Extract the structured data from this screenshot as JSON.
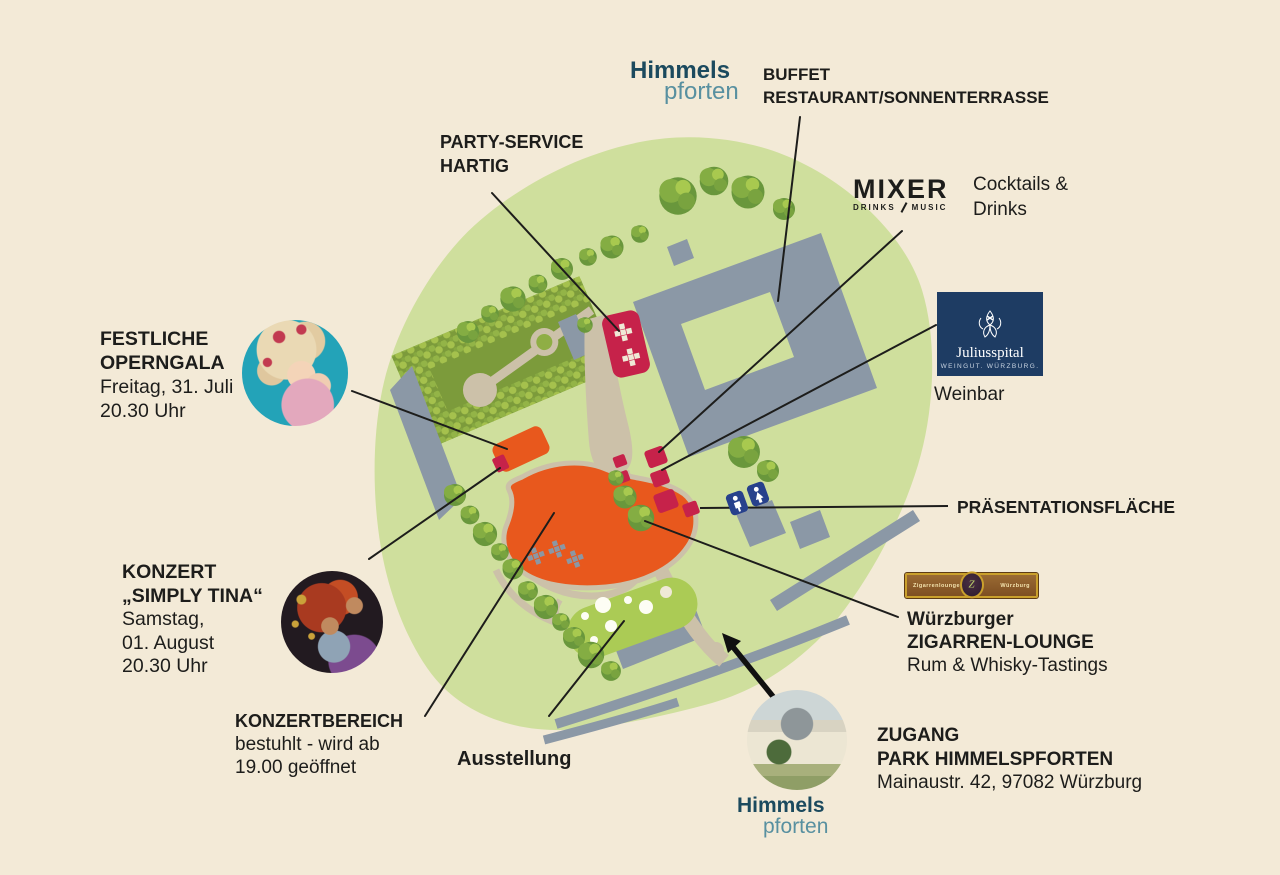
{
  "colors": {
    "background": "#f3ead7",
    "park_green": "#cfdf9d",
    "garden_green": "#7c9b3b",
    "exhibition_green": "#abcb55",
    "building_gray": "#8b98a6",
    "path_tan": "#ccc1a9",
    "stage_orange": "#e8581d",
    "booth_red": "#c6224a",
    "wc_blue": "#27418c",
    "line_black": "#1d1d1b",
    "logo_teal_dark": "#1b4a5e",
    "logo_teal_light": "#5890a0",
    "julius_navy": "#1e3c63",
    "zigarren_gold": "#caa02c"
  },
  "header_logo": {
    "word1": "Himmels",
    "word2": "pforten"
  },
  "footer_logo": {
    "word1": "Himmels",
    "word2": "pforten"
  },
  "annotations": {
    "buffet": {
      "line1": "BUFFET",
      "line2": "RESTAURANT/SONNENTERRASSE"
    },
    "party_service": {
      "line1": "PARTY-SERVICE",
      "line2": "HARTIG"
    },
    "mixer": {
      "logo_name": "MIXER",
      "logo_sub_left": "DRINKS",
      "logo_sub_right": "MUSIC",
      "desc_line1": "Cocktails &",
      "desc_line2": "Drinks"
    },
    "juliusspital": {
      "logo_name": "Juliusspital",
      "logo_sub": "WEINGUT. WÜRZBURG.",
      "desc": "Weinbar"
    },
    "operngala": {
      "title_line1": "FESTLICHE",
      "title_line2": "OPERNGALA",
      "detail_line1": "Freitag, 31. Juli",
      "detail_line2": "20.30 Uhr"
    },
    "simply_tina": {
      "title_line1": "KONZERT",
      "title_line2": "„SIMPLY TINA“",
      "detail_line1": "Samstag,",
      "detail_line2": "01. August",
      "detail_line3": "20.30 Uhr"
    },
    "konzertbereich": {
      "title": "KONZERTBEREICH",
      "detail_line1": "bestuhlt - wird ab",
      "detail_line2": "19.00 geöffnet"
    },
    "ausstellung": {
      "title": "Ausstellung"
    },
    "praesentationsflaeche": {
      "title": "PRÄSENTATIONSFLÄCHE"
    },
    "zigarren_lounge": {
      "logo_left": "Zigarrenlounge",
      "logo_right": "Würzburg",
      "logo_monogram": "Z",
      "line1": "Würzburger",
      "line2": "ZIGARREN-LOUNGE",
      "line3": "Rum & Whisky-Tastings"
    },
    "zugang": {
      "line1": "ZUGANG",
      "line2": "PARK HIMMELSPFORTEN",
      "line3": "Mainaustr. 42, 97082 Würzburg"
    }
  }
}
